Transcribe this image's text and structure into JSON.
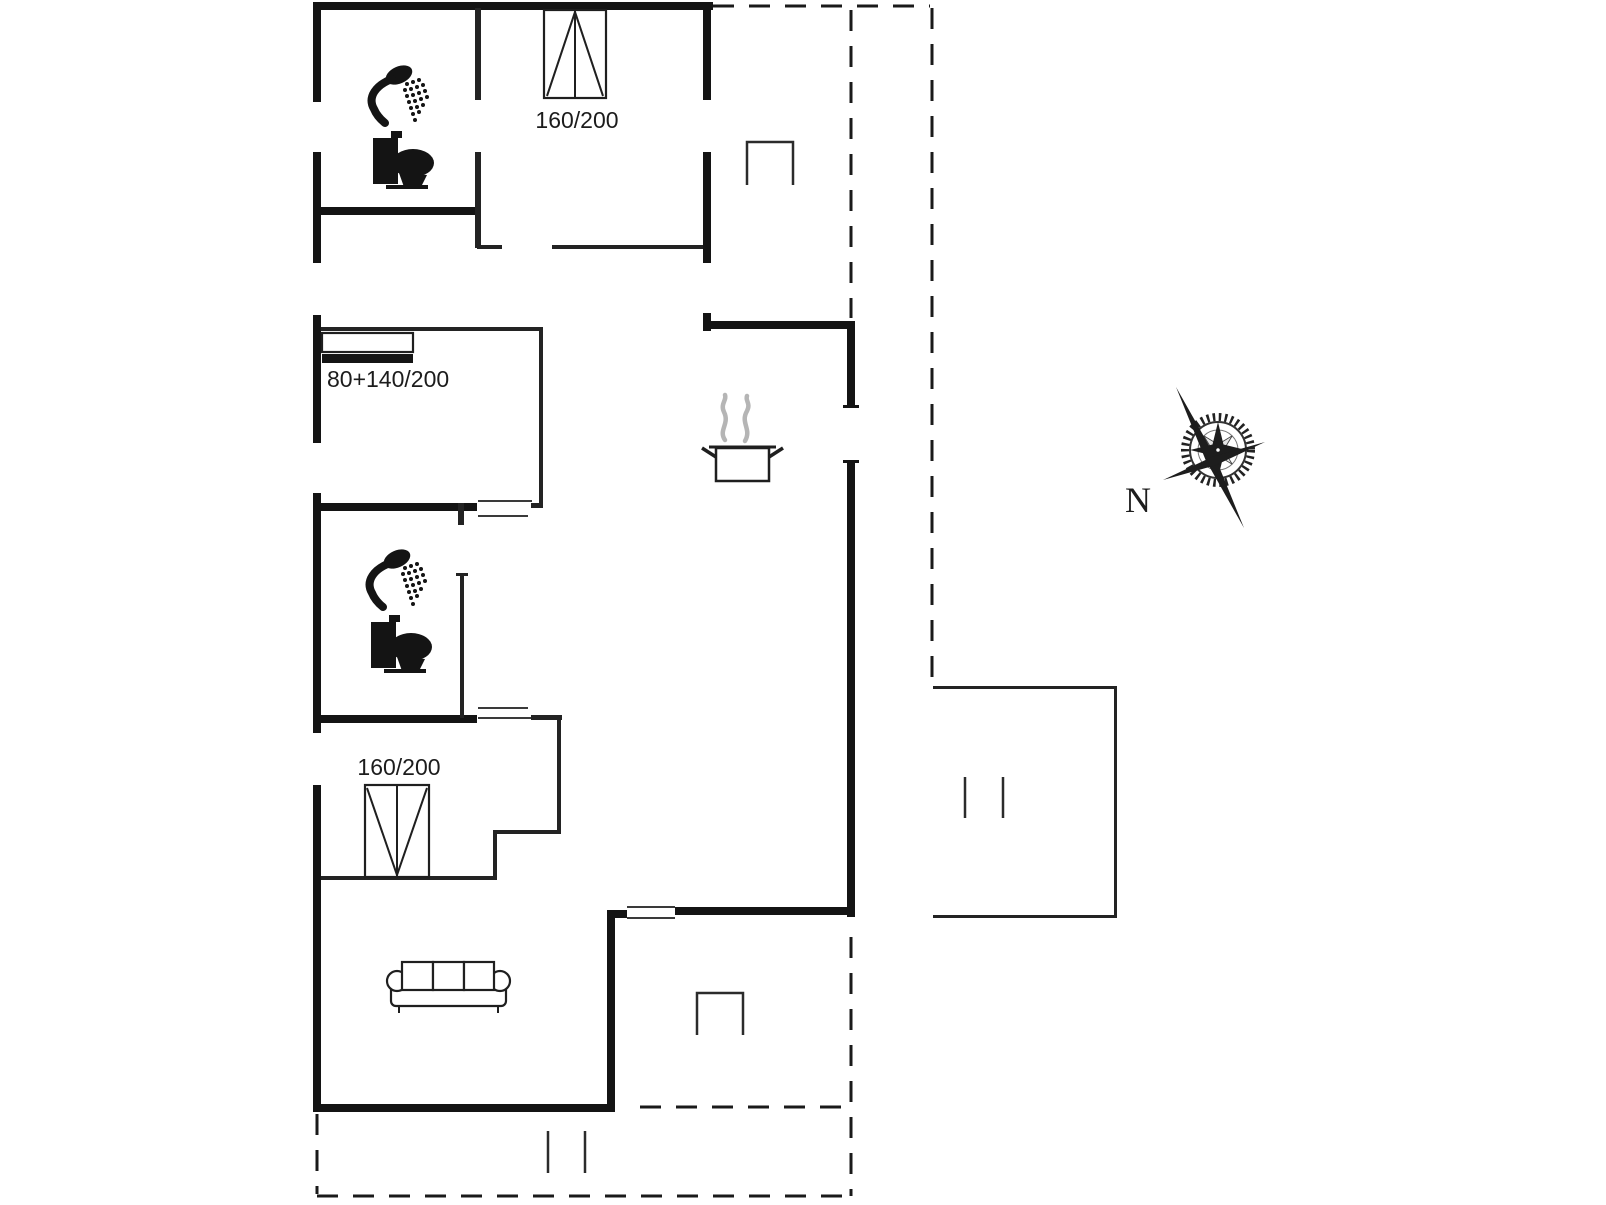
{
  "canvas": {
    "width": 1606,
    "height": 1205,
    "background": "#ffffff"
  },
  "colors": {
    "wall": "#141414",
    "interior_line": "#232323",
    "dashed_outline": "#1a1a1a",
    "steam": "#b5b5b5",
    "text": "#1c1c1c"
  },
  "labels": {
    "bed_top": "160/200",
    "bed_middle": "80+140/200",
    "bed_lower": "160/200",
    "compass_north": "N"
  },
  "icons": {
    "bathroom_top": [
      "shower-icon",
      "toilet-icon"
    ],
    "bathroom_middle": [
      "shower-icon",
      "toilet-icon"
    ],
    "kitchen": [
      "cooking-pot-icon"
    ],
    "living_room": [
      "sofa-icon"
    ],
    "terrace_top": [
      "chair-icon"
    ],
    "terrace_bottom": [
      "chair-icon"
    ],
    "annex": [
      "double-door-ticks"
    ],
    "compass": [
      "compass-rose-icon"
    ]
  }
}
